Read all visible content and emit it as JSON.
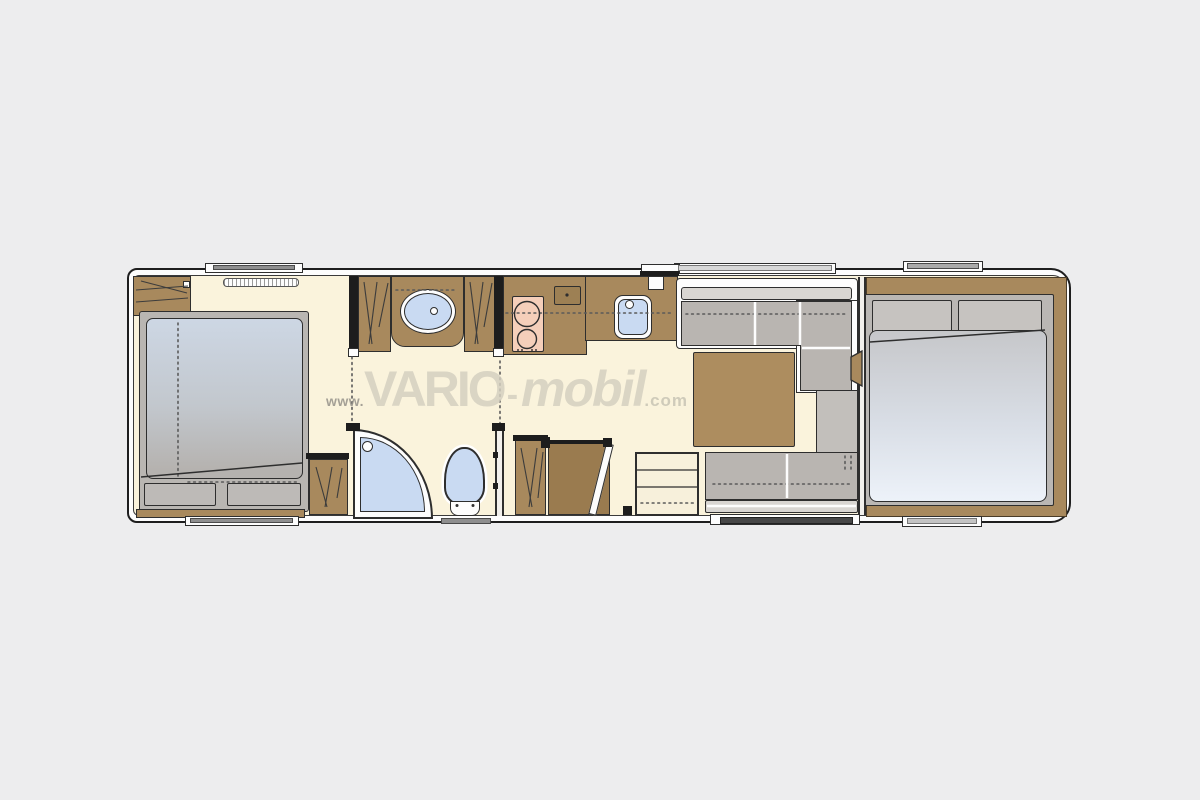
{
  "watermark": {
    "www": "www.",
    "brand": "VARIO",
    "dash": "-",
    "brand2": "mobil",
    "tld": ".com"
  },
  "colors": {
    "page_background": "#ededee",
    "body_shell": "#fdfdfd",
    "floor": "#faf3dc",
    "wood": "#a8895d",
    "wood_dark": "#9a7b4f",
    "upholstery": "#b9b5b1",
    "upholstery_light": "#d9d6d2",
    "mattress_top": "#cdd7e4",
    "mattress_bottom": "#edf2f9",
    "fixture_blue": "#c9daf2",
    "cooktop": "#f5cfba",
    "outline": "#2e2e2e"
  },
  "rooms": {
    "rear_bedroom": {
      "furniture": [
        "double-bed",
        "wardrobe",
        "wardrobe",
        "window"
      ]
    },
    "bathroom": {
      "furniture": [
        "washbasin-vanity",
        "wardrobe",
        "wardrobe",
        "shower",
        "toilet"
      ]
    },
    "kitchen": {
      "furniture": [
        "cooktop",
        "sink",
        "counter"
      ]
    },
    "lounge": {
      "furniture": [
        "l-sofa",
        "table",
        "bench-sofa",
        "entry-door",
        "entry-steps"
      ]
    },
    "front_bedroom": {
      "furniture": [
        "double-bed",
        "window"
      ]
    }
  }
}
